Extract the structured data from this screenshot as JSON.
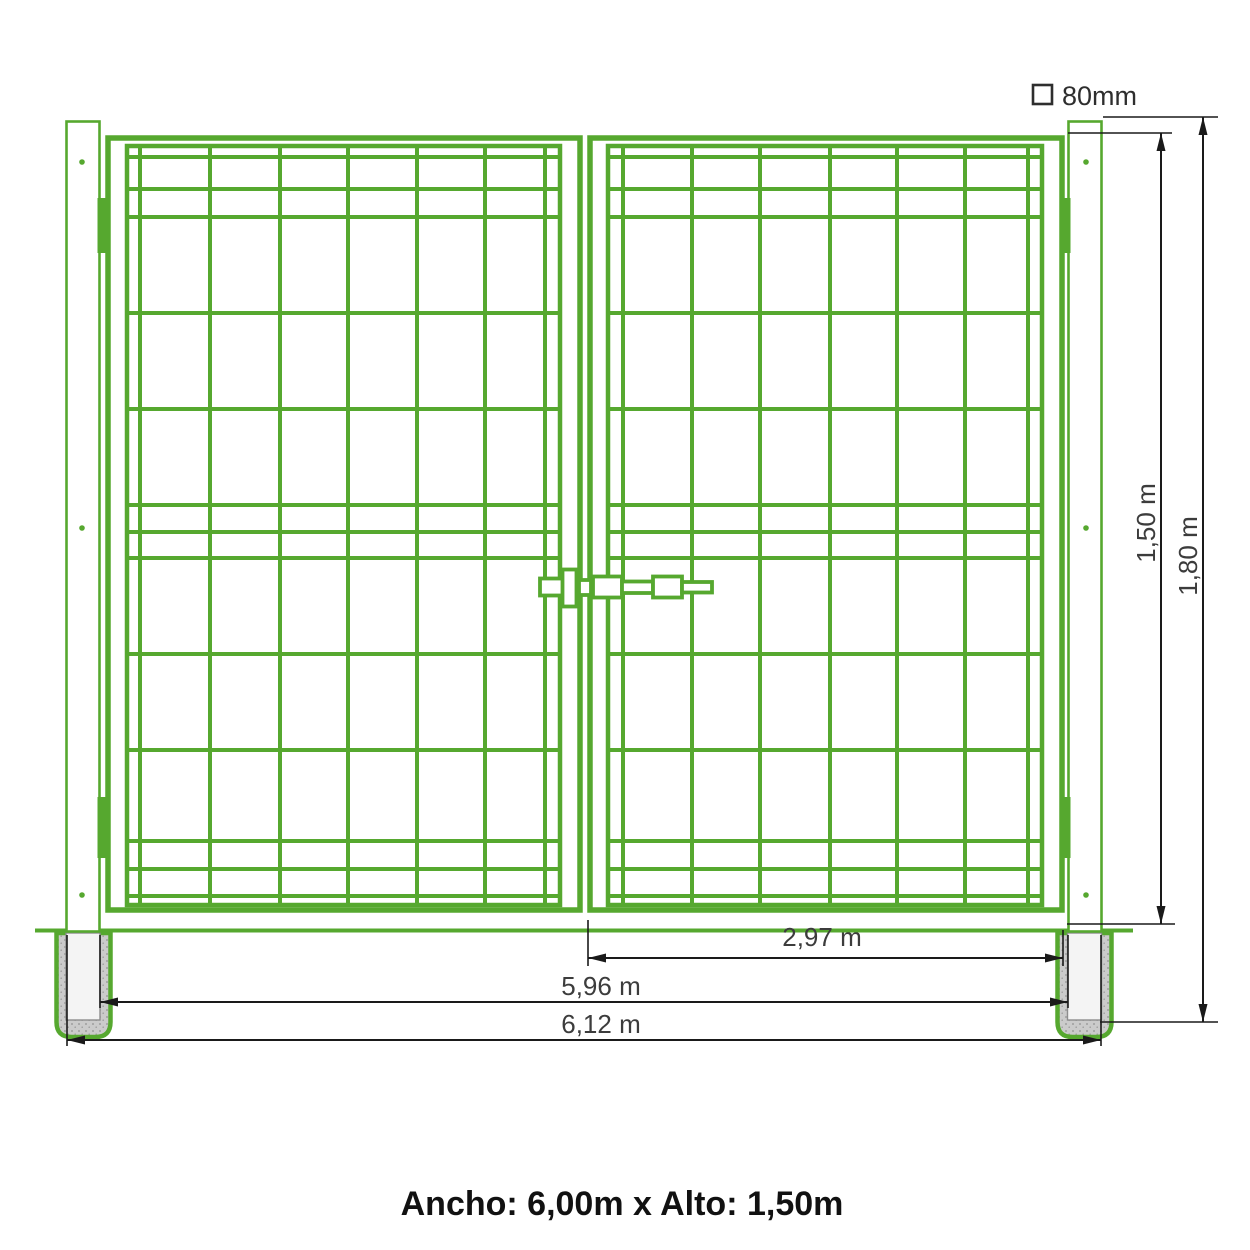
{
  "diagram": {
    "caption": "Ancho: 6,00m x Alto: 1,50m",
    "profile": {
      "label": "80mm"
    },
    "dimensions": {
      "gate_height": "1,50 m",
      "post_height": "1,80 m",
      "leaf_width": "2,97 m",
      "clear_width": "5,96 m",
      "total_width": "6,12 m"
    },
    "colors": {
      "gate_green": "#56a82f",
      "dimension_line": "#1a1a1a",
      "dimension_text": "#3c3c3c",
      "caption_text": "#111111",
      "concrete": "#cbcbcb",
      "concrete_speckle": "#9e9e9e",
      "post_hole": "#f4f4f4"
    }
  }
}
